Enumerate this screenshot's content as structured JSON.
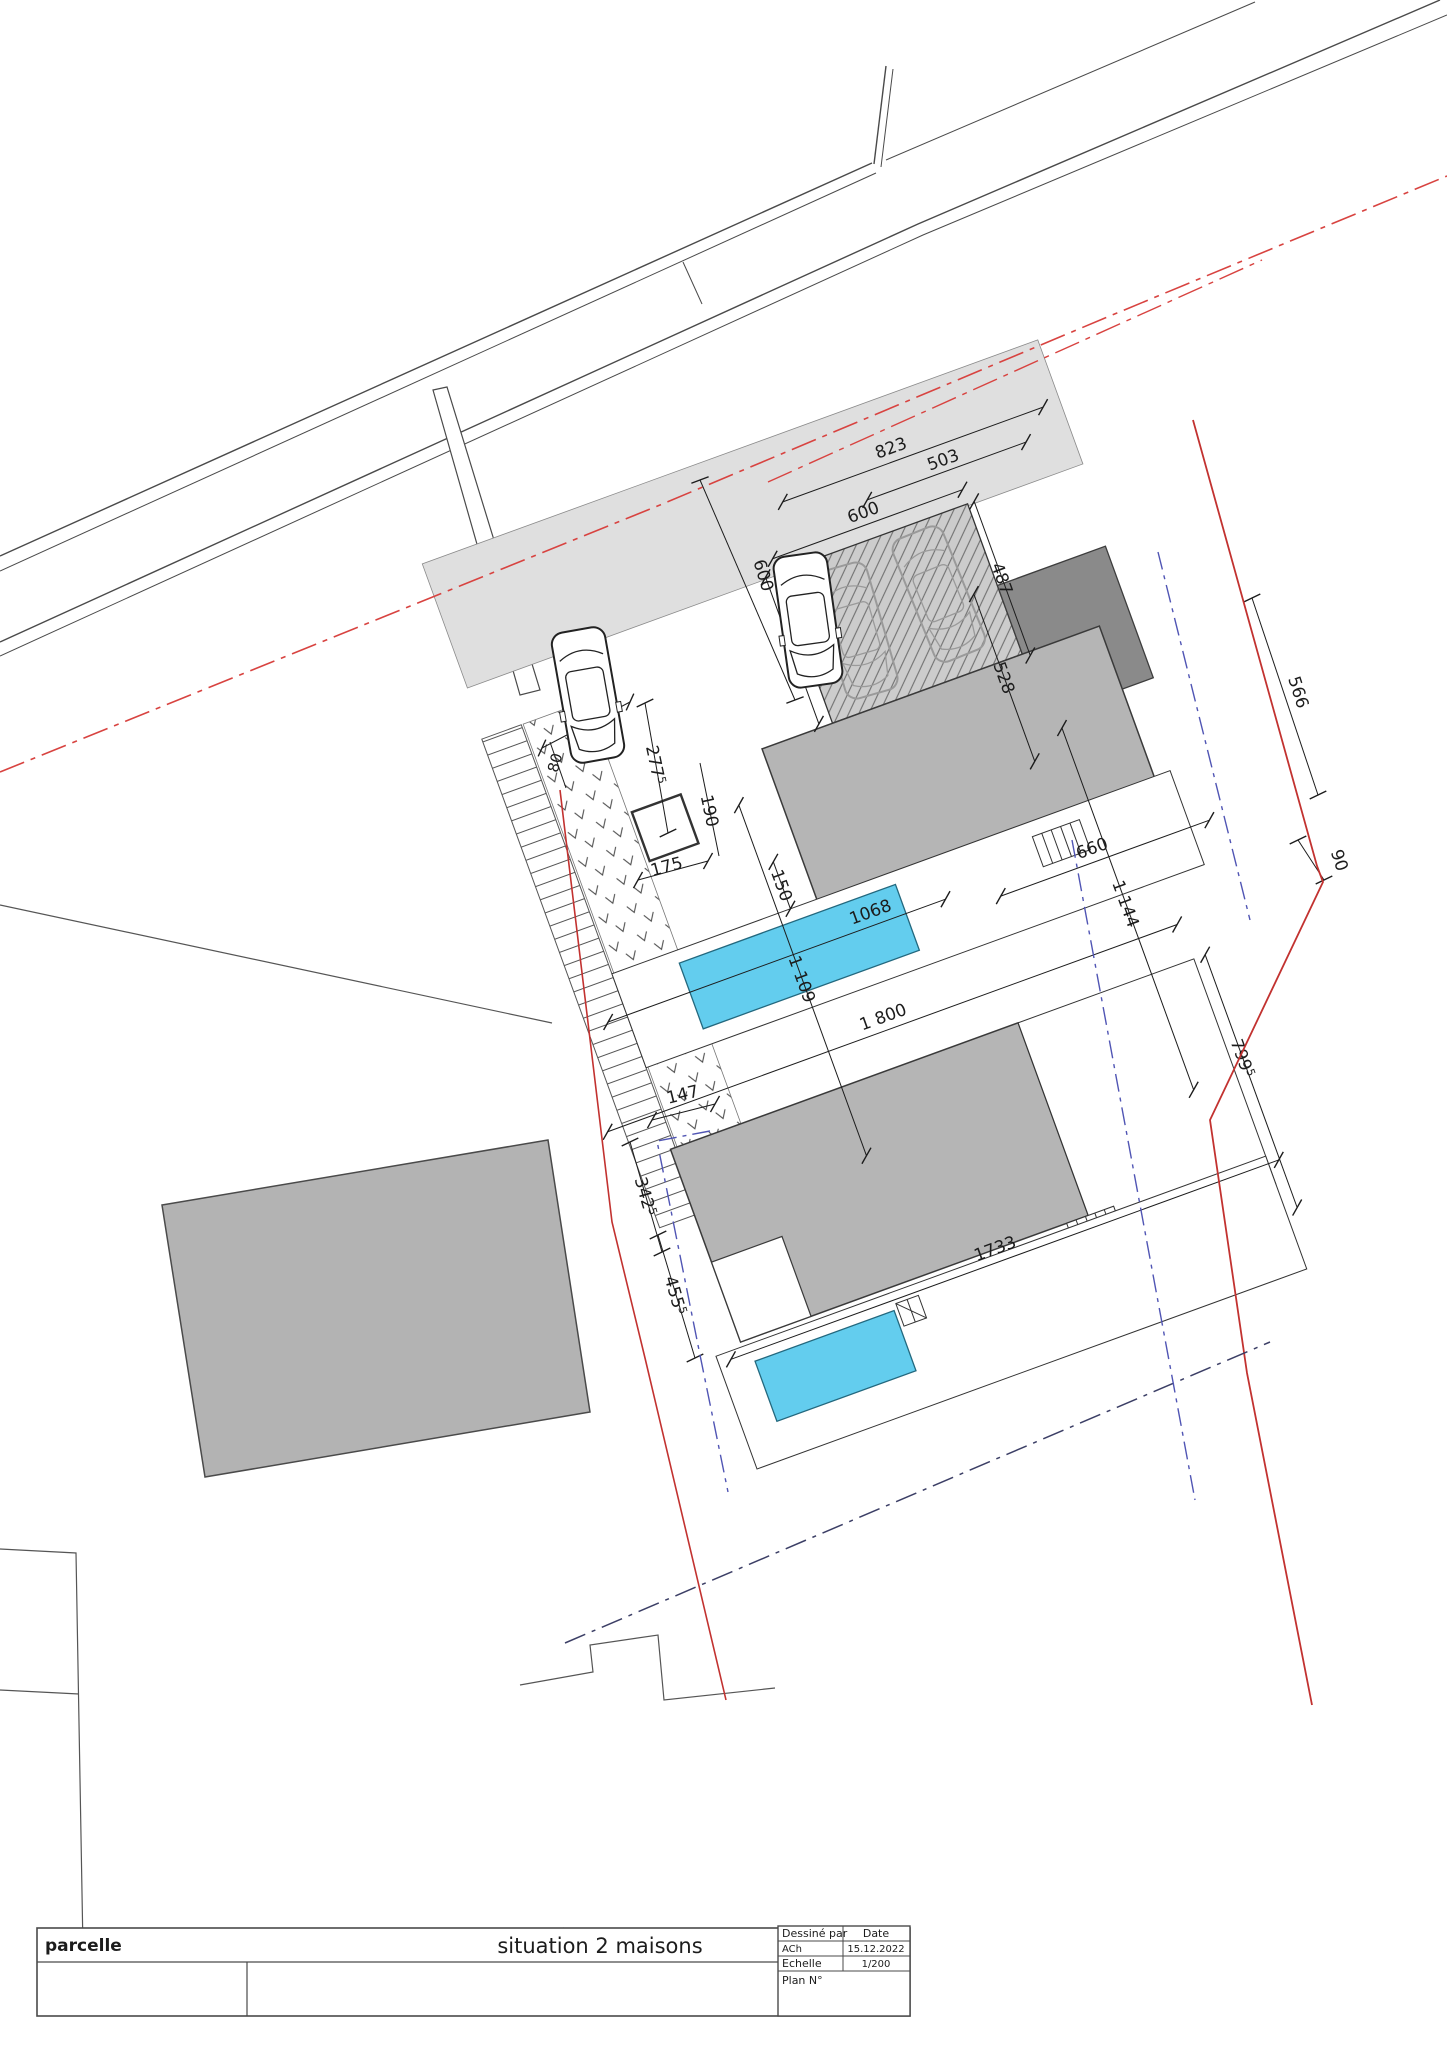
{
  "title_block": {
    "left_label": "parcelle",
    "title": "situation 2 maisons",
    "drawn_by_label": "Dessiné par",
    "drawn_by_value": "ACh",
    "date_label": "Date",
    "date_value": "15.12.2022",
    "scale_label": "Echelle",
    "scale_value": "1/200",
    "plan_no_label": "Plan N°"
  },
  "dims": {
    "d823": "823",
    "d503": "503",
    "d600_street": "600",
    "d600_carport": "600",
    "d463": "463",
    "d487": "487",
    "d240": "240",
    "d80": "80",
    "d277": "277",
    "d277_sup": "5",
    "d190": "190",
    "d175": "175",
    "d528": "528",
    "d566": "566",
    "d90": "90",
    "d660": "660",
    "d1068": "1068",
    "d1144": "1 144",
    "d150": "150",
    "d1109": "1 109",
    "d1800": "1 800",
    "d147": "147",
    "d342": "342",
    "d342_sup": "5",
    "d455": "455",
    "d455_sup": "5",
    "d1733": "1733",
    "d799": "799",
    "d799_sup": "5"
  },
  "colors": {
    "boundary_red": "#c23230",
    "centerline_red": "#d84340",
    "setback_blue": "#5055b4",
    "pool_water": "#63cdee",
    "building_dark": "#8a8a8a",
    "building_mid": "#b5b5b5",
    "surface_light": "#dfdfdf",
    "hatch_bg": "#cccccc"
  },
  "features": {
    "house1": "maison 1",
    "house2": "maison 2",
    "pool1": "piscine 1",
    "pool2": "piscine 2",
    "carport": "carport",
    "garage": "garage",
    "street": "rue",
    "parcel": "parcelle"
  }
}
